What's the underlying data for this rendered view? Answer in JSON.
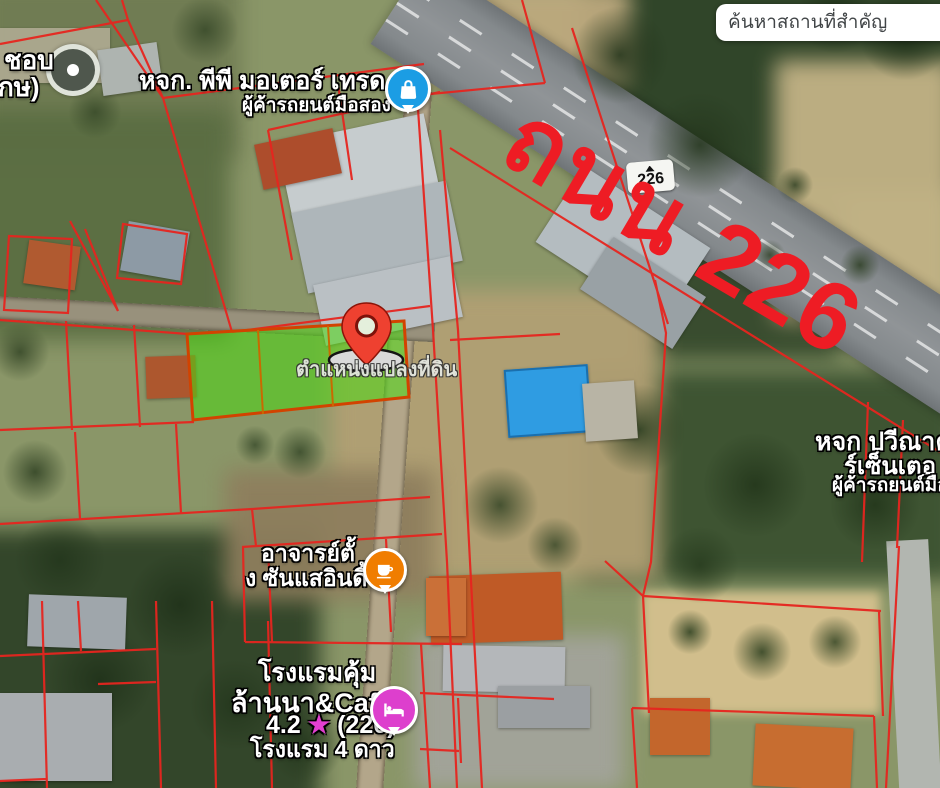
{
  "app": {
    "type": "satellite-map-with-cadastral-overlay"
  },
  "search": {
    "placeholder": "ค้นหาสถานที่สำคัญ"
  },
  "road_annotation": {
    "text": "ถนน 226",
    "color": "#ee1c24"
  },
  "road_sign": {
    "route_number": "226"
  },
  "map_labels": {
    "top_left_partial": {
      "line1": "ชอบ",
      "line2": "กษ)"
    },
    "pp_motor_trade": {
      "name": "หจก. พีพี มอเตอร์ เทรด",
      "subtitle": "ผู้ค้ารถยนต์มือสอง"
    },
    "plot_location": {
      "text": "ตำแหน่งแปลงที่ดิน"
    },
    "paweena_car_center": {
      "line1": "หจก ปวีณาคา",
      "line2": "ร์เซ็นเตอ",
      "line3": "ผู้ค้ารถยนต์มือสอ"
    },
    "ajarn_tang": {
      "line1": "อาจารย์ตั้",
      "line2": "ง ซันแสอินดี้"
    },
    "khum_lanna_hotel": {
      "line1": "โรงแรมคุ้ม",
      "line2": "ล้านนา&Cafe",
      "rating": "4.2",
      "star": "★",
      "review_count": "(220)",
      "line4": "โรงแรม 4 ดาว"
    }
  },
  "markers": {
    "shopping": {
      "icon": "shopping-bag-icon",
      "color": "#1b9de4"
    },
    "cafe": {
      "icon": "coffee-cup-icon",
      "color": "#f07d00"
    },
    "hotel": {
      "icon": "bed-icon",
      "color": "#dd3fcd"
    },
    "plot_pin": {
      "icon": "location-pin-icon",
      "color": "#ee4130"
    }
  },
  "overlay_colors": {
    "parcel_lines": "#e6251f",
    "highlight_parcel_fill": "#3ed60e",
    "highlight_parcel_border": "#d24300"
  }
}
